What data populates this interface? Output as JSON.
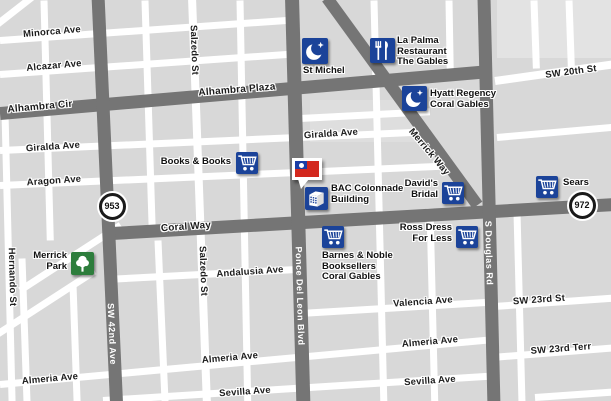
{
  "map": {
    "colors": {
      "block_gray": "#d8d8d8",
      "block_light": "#e3e3e3",
      "road_white": "#ffffff",
      "road_dark": "#757575",
      "poi_blue": "#1b4399",
      "park_green": "#2d7d3c",
      "flag_red": "#d3281e",
      "flag_blue": "#1b3ea6",
      "label_black": "#1c1c1c",
      "label_white": "#ffffff"
    },
    "blocks": [
      {
        "id": "block-ne-light",
        "x": 497,
        "y": 0,
        "w": 114,
        "h": 58,
        "color": "#e3e3e3"
      },
      {
        "id": "block-hyatt-light",
        "x": 310,
        "y": 100,
        "w": 110,
        "h": 42,
        "color": "#dedede"
      }
    ],
    "roads": [
      {
        "id": "minorca-ave",
        "kind": "white",
        "x": 0,
        "y": 40,
        "len": 298,
        "t": 7,
        "rot": -4
      },
      {
        "id": "alcazar-ave",
        "kind": "white",
        "x": 0,
        "y": 74,
        "len": 298,
        "t": 7,
        "rot": -4
      },
      {
        "id": "topleft-diagonal",
        "kind": "white",
        "x": -8,
        "y": 28,
        "len": 60,
        "t": 7,
        "rot": -38
      },
      {
        "id": "giralda-ave",
        "kind": "white",
        "x": 0,
        "y": 150,
        "len": 430,
        "t": 7,
        "rot": -2.5
      },
      {
        "id": "aragon-ave",
        "kind": "white",
        "x": 0,
        "y": 185,
        "len": 445,
        "t": 7,
        "rot": -2.5
      },
      {
        "id": "hyatt-block-st",
        "kind": "white",
        "x": 300,
        "y": 118,
        "len": 130,
        "t": 7,
        "rot": -3
      },
      {
        "id": "andalusia-ave",
        "kind": "white",
        "x": 106,
        "y": 279,
        "len": 200,
        "t": 7,
        "rot": -3
      },
      {
        "id": "almeria-ave",
        "kind": "white",
        "x": 0,
        "y": 384,
        "len": 500,
        "t": 7,
        "rot": -5.2
      },
      {
        "id": "sevilla-ave",
        "kind": "white",
        "x": 103,
        "y": 400,
        "len": 395,
        "t": 7,
        "rot": -3.6
      },
      {
        "id": "valencia-ave",
        "kind": "white",
        "x": 300,
        "y": 313,
        "len": 192,
        "t": 7,
        "rot": -3.4
      },
      {
        "id": "sw-23rd-st",
        "kind": "white",
        "x": 494,
        "y": 306,
        "len": 118,
        "t": 7,
        "rot": -4
      },
      {
        "id": "sw-23rd-terr",
        "kind": "white",
        "x": 492,
        "y": 357,
        "len": 120,
        "t": 7,
        "rot": -4.5
      },
      {
        "id": "sw-20th-st",
        "kind": "white",
        "x": 495,
        "y": 81,
        "len": 118,
        "t": 8,
        "rot": -8
      },
      {
        "id": "east-mid-st",
        "kind": "white",
        "x": 497,
        "y": 137,
        "len": 116,
        "t": 7,
        "rot": -5
      },
      {
        "id": "bottom-right-st",
        "kind": "white",
        "x": 535,
        "y": 397,
        "len": 78,
        "t": 7,
        "rot": -4
      },
      {
        "id": "park-diagonal-1",
        "kind": "white",
        "x": 20,
        "y": 290,
        "len": 120,
        "t": 7,
        "rot": -33
      },
      {
        "id": "park-diagonal-2",
        "kind": "white",
        "x": -6,
        "y": 336,
        "len": 120,
        "t": 7,
        "rot": -33
      },
      {
        "id": "hernando-st",
        "kind": "white",
        "x": 5,
        "y": 112,
        "len": 292,
        "t": 7,
        "rot": 88.6
      },
      {
        "id": "west-st-1",
        "kind": "white",
        "x": 44,
        "y": 0,
        "len": 240,
        "t": 7,
        "rot": 88.5
      },
      {
        "id": "west-st-2",
        "kind": "white",
        "x": 22,
        "y": 258,
        "len": 146,
        "t": 7,
        "rot": 88
      },
      {
        "id": "west-st-3",
        "kind": "white",
        "x": 73,
        "y": 284,
        "len": 120,
        "t": 7,
        "rot": 88
      },
      {
        "id": "mid-st-1",
        "kind": "white",
        "x": 145,
        "y": 0,
        "len": 225,
        "t": 7,
        "rot": 88.2
      },
      {
        "id": "mid-st-2",
        "kind": "white",
        "x": 158,
        "y": 240,
        "len": 165,
        "t": 7,
        "rot": 87.5
      },
      {
        "id": "salzedo-st",
        "kind": "white",
        "x": 192,
        "y": -3,
        "len": 410,
        "t": 8,
        "rot": 87.9
      },
      {
        "id": "mid-st-3",
        "kind": "white",
        "x": 240,
        "y": 0,
        "len": 405,
        "t": 7,
        "rot": 88.9
      },
      {
        "id": "mid-st-4",
        "kind": "white",
        "x": 374,
        "y": 0,
        "len": 405,
        "t": 7,
        "rot": 88.6
      },
      {
        "id": "lapalma-block-st",
        "kind": "white",
        "x": 449,
        "y": 0,
        "len": 75,
        "t": 7,
        "rot": 89
      },
      {
        "id": "east-st-1",
        "kind": "white",
        "x": 517,
        "y": 212,
        "len": 192,
        "t": 7,
        "rot": 88.5
      },
      {
        "id": "ne-st-1",
        "kind": "white",
        "x": 534,
        "y": 0,
        "len": 68,
        "t": 7,
        "rot": 88
      },
      {
        "id": "ne-st-2",
        "kind": "white",
        "x": 569,
        "y": 0,
        "len": 66,
        "t": 7,
        "rot": 88
      },
      {
        "id": "east-st-2",
        "kind": "white",
        "x": 430,
        "y": 208,
        "len": 196,
        "t": 7,
        "rot": 88.6
      },
      {
        "id": "alhambra",
        "kind": "dark",
        "x": 0,
        "y": 113,
        "len": 492,
        "t": 13,
        "rot": -4.9
      },
      {
        "id": "coral-way",
        "kind": "dark",
        "x": 112,
        "y": 233,
        "len": 502,
        "t": 13,
        "rot": -3.3
      },
      {
        "id": "sw-42nd-ave",
        "kind": "dark",
        "x": 98,
        "y": -5,
        "len": 412,
        "t": 13,
        "rot": 87.4
      },
      {
        "id": "ponce-de-leon",
        "kind": "dark",
        "x": 292,
        "y": -3,
        "len": 408,
        "t": 14,
        "rot": 88.4
      },
      {
        "id": "s-douglas-rd",
        "kind": "dark",
        "x": 484,
        "y": -3,
        "len": 408,
        "t": 13,
        "rot": 88.6
      },
      {
        "id": "merrick-way",
        "kind": "dark",
        "x": 327,
        "y": -2,
        "len": 256,
        "t": 12,
        "rot": 54
      }
    ],
    "street_labels": [
      {
        "text": "Minorca Ave",
        "x": 52,
        "y": 32,
        "rot": -5,
        "variant": "minor"
      },
      {
        "text": "Alcazar Ave",
        "x": 54,
        "y": 66,
        "rot": -5,
        "variant": "minor"
      },
      {
        "text": "Alhambra Cir",
        "x": 40,
        "y": 107,
        "rot": -5,
        "variant": "major"
      },
      {
        "text": "Alhambra Plaza",
        "x": 237,
        "y": 90,
        "rot": -4.5,
        "variant": "major"
      },
      {
        "text": "Salzedo St",
        "x": 194,
        "y": 50,
        "rot": 87.9,
        "variant": "minor-vertical"
      },
      {
        "text": "Giralda Ave",
        "x": 53,
        "y": 147,
        "rot": -4,
        "variant": "minor"
      },
      {
        "text": "Giralda Ave",
        "x": 331,
        "y": 134,
        "rot": -4,
        "variant": "minor"
      },
      {
        "text": "Aragon Ave",
        "x": 54,
        "y": 181,
        "rot": -4,
        "variant": "minor"
      },
      {
        "text": "Merrick Way",
        "x": 429,
        "y": 152,
        "rot": 50,
        "variant": "diag"
      },
      {
        "text": "Coral Way",
        "x": 186,
        "y": 227,
        "rot": -4,
        "variant": "major"
      },
      {
        "text": "SW 42nd Ave",
        "x": 112,
        "y": 334,
        "rot": 87.4,
        "variant": "major-vertical"
      },
      {
        "text": "Ponce Del Leon Blvd",
        "x": 300,
        "y": 296,
        "rot": 88.4,
        "variant": "major-vertical"
      },
      {
        "text": "S Douglas Rd",
        "x": 489,
        "y": 253,
        "rot": 88.6,
        "variant": "major-vertical"
      },
      {
        "text": "Hernando St",
        "x": 12,
        "y": 277,
        "rot": 88.6,
        "variant": "minor-vertical"
      },
      {
        "text": "Salzedo St",
        "x": 203,
        "y": 271,
        "rot": 87.9,
        "variant": "minor-vertical"
      },
      {
        "text": "Andalusia Ave",
        "x": 250,
        "y": 272,
        "rot": -4,
        "variant": "minor"
      },
      {
        "text": "Almeria Ave",
        "x": 50,
        "y": 379,
        "rot": -5,
        "variant": "minor"
      },
      {
        "text": "Almeria Ave",
        "x": 230,
        "y": 358,
        "rot": -5,
        "variant": "minor"
      },
      {
        "text": "Almeria Ave",
        "x": 430,
        "y": 342,
        "rot": -5,
        "variant": "minor"
      },
      {
        "text": "Sevilla Ave",
        "x": 245,
        "y": 392,
        "rot": -4,
        "variant": "minor"
      },
      {
        "text": "Sevilla Ave",
        "x": 430,
        "y": 381,
        "rot": -4,
        "variant": "minor"
      },
      {
        "text": "Valencia Ave",
        "x": 423,
        "y": 302,
        "rot": -4,
        "variant": "minor"
      },
      {
        "text": "SW 23rd St",
        "x": 539,
        "y": 300,
        "rot": -4,
        "variant": "minor"
      },
      {
        "text": "SW 23rd Terr",
        "x": 561,
        "y": 349,
        "rot": -4.5,
        "variant": "minor"
      },
      {
        "text": "SW 20th St",
        "x": 571,
        "y": 72,
        "rot": -7.5,
        "variant": "minor"
      }
    ],
    "route_shields": [
      {
        "number": "953",
        "x": 112,
        "y": 206
      },
      {
        "number": "972",
        "x": 582,
        "y": 205
      }
    ],
    "pois": [
      {
        "id": "st-michel",
        "icon": "hotel",
        "x": 302,
        "y": 38,
        "size": 26,
        "label": {
          "lines": [
            "St Michel"
          ],
          "x": 303,
          "y": 66,
          "align": "left"
        }
      },
      {
        "id": "la-palma",
        "icon": "restaurant",
        "x": 370,
        "y": 38,
        "size": 25,
        "label": {
          "lines": [
            "La Palma",
            "Restaurant",
            "The Gables"
          ],
          "x": 397,
          "y": 36,
          "align": "left"
        }
      },
      {
        "id": "hyatt-regency",
        "icon": "hotel",
        "x": 402,
        "y": 86,
        "size": 25,
        "label": {
          "lines": [
            "Hyatt Regency",
            "Coral Gables"
          ],
          "x": 430,
          "y": 89,
          "align": "left"
        }
      },
      {
        "id": "books-and-books",
        "icon": "cart",
        "x": 236,
        "y": 152,
        "size": 22,
        "label": {
          "lines": [
            "Books & Books"
          ],
          "x": 231,
          "y": 157,
          "align": "right"
        }
      },
      {
        "id": "bac-colonnade",
        "icon": "building",
        "x": 305,
        "y": 187,
        "size": 23,
        "label": {
          "lines": [
            "BAC Colonnade",
            "Building"
          ],
          "x": 331,
          "y": 184,
          "align": "left"
        }
      },
      {
        "id": "davids-bridal",
        "icon": "cart",
        "x": 442,
        "y": 182,
        "size": 22,
        "label": {
          "lines": [
            "David's",
            "Bridal"
          ],
          "x": 438,
          "y": 179,
          "align": "right"
        }
      },
      {
        "id": "sears",
        "icon": "cart",
        "x": 536,
        "y": 176,
        "size": 22,
        "label": {
          "lines": [
            "Sears"
          ],
          "x": 563,
          "y": 178,
          "align": "left"
        }
      },
      {
        "id": "barnes-noble",
        "icon": "cart",
        "x": 322,
        "y": 226,
        "size": 22,
        "label": {
          "lines": [
            "Barnes & Noble",
            "Booksellers",
            "Coral Gables"
          ],
          "x": 322,
          "y": 251,
          "align": "left"
        }
      },
      {
        "id": "ross-dress",
        "icon": "cart",
        "x": 456,
        "y": 226,
        "size": 22,
        "label": {
          "lines": [
            "Ross Dress",
            "For Less"
          ],
          "x": 452,
          "y": 223,
          "align": "right"
        }
      },
      {
        "id": "merrick-park",
        "icon": "park",
        "x": 71,
        "y": 252,
        "size": 23,
        "label": {
          "lines": [
            "Merrick",
            "Park"
          ],
          "x": 67,
          "y": 251,
          "align": "right"
        }
      }
    ],
    "flag_marker": {
      "id": "taiwan-flag-marker",
      "x": 292,
      "y": 158,
      "w": 30,
      "h": 22,
      "tip_x": 298,
      "tip_y": 179
    }
  }
}
